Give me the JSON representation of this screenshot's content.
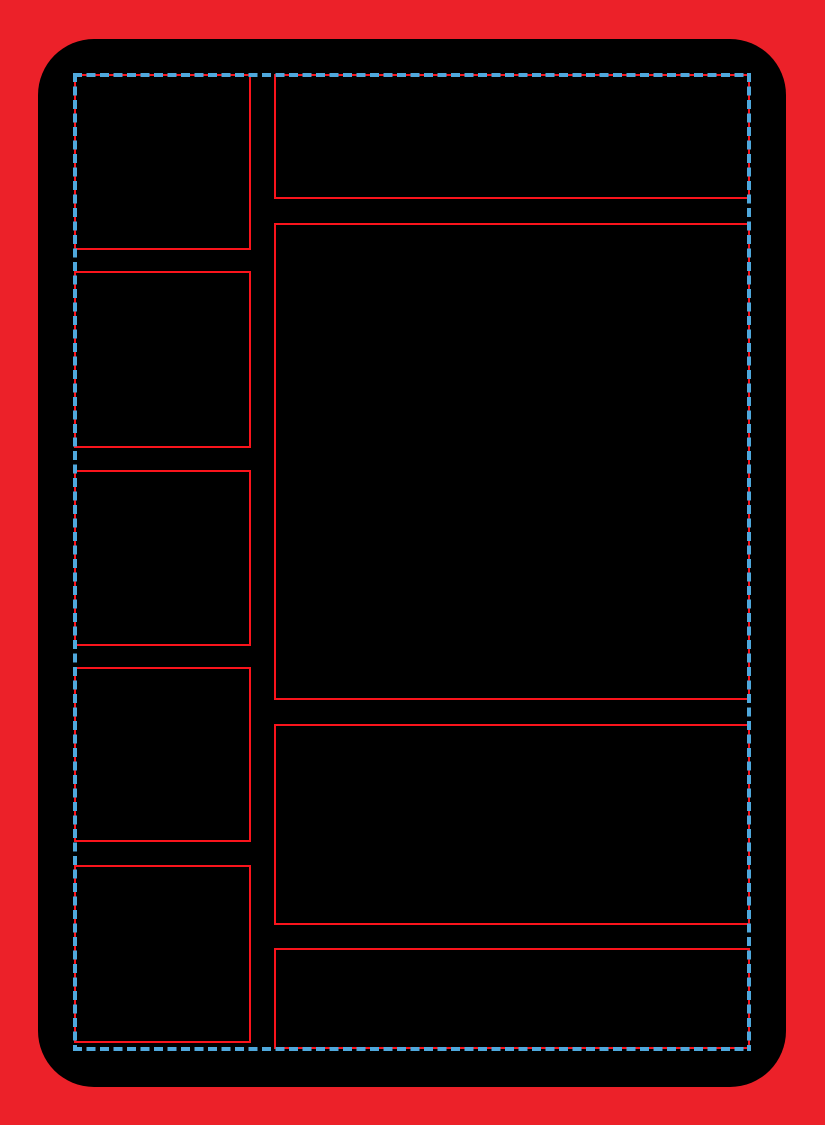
{
  "template": {
    "kind": "card-layout-template",
    "canvas": {
      "width": 825,
      "height": 1125
    },
    "colors": {
      "bleed_background_red": "#EC2129",
      "card_black": "#000000",
      "frame_outline_red": "#FA141C",
      "safe_guide_blue": "#4FA8DC"
    },
    "card": {
      "x": 38,
      "y": 39,
      "width": 748,
      "height": 1048,
      "corner_radius": 56
    },
    "safe_area": {
      "x": 73,
      "y": 73,
      "width": 678,
      "height": 978,
      "line_style": "dashed",
      "line_thickness": 4,
      "dash_length": 9,
      "dash_gap": 4.5
    },
    "frames": {
      "left_column": [
        {
          "name": "left-frame-box-1",
          "x": 74,
          "y": 74,
          "width": 177,
          "height": 176
        },
        {
          "name": "left-frame-box-2",
          "x": 74,
          "y": 271,
          "width": 177,
          "height": 177
        },
        {
          "name": "left-frame-box-3",
          "x": 74,
          "y": 470,
          "width": 177,
          "height": 176
        },
        {
          "name": "left-frame-box-4",
          "x": 74,
          "y": 667,
          "width": 177,
          "height": 175
        },
        {
          "name": "left-frame-box-5",
          "x": 74,
          "y": 865,
          "width": 177,
          "height": 178
        }
      ],
      "right_column": [
        {
          "name": "right-frame-header-panel",
          "x": 274,
          "y": 74,
          "width": 476,
          "height": 125
        },
        {
          "name": "right-frame-image-panel",
          "x": 274,
          "y": 223,
          "width": 476,
          "height": 477
        },
        {
          "name": "right-frame-text-panel",
          "x": 274,
          "y": 724,
          "width": 476,
          "height": 201
        },
        {
          "name": "right-frame-footer-panel",
          "x": 274,
          "y": 948,
          "width": 476,
          "height": 101
        }
      ]
    }
  }
}
